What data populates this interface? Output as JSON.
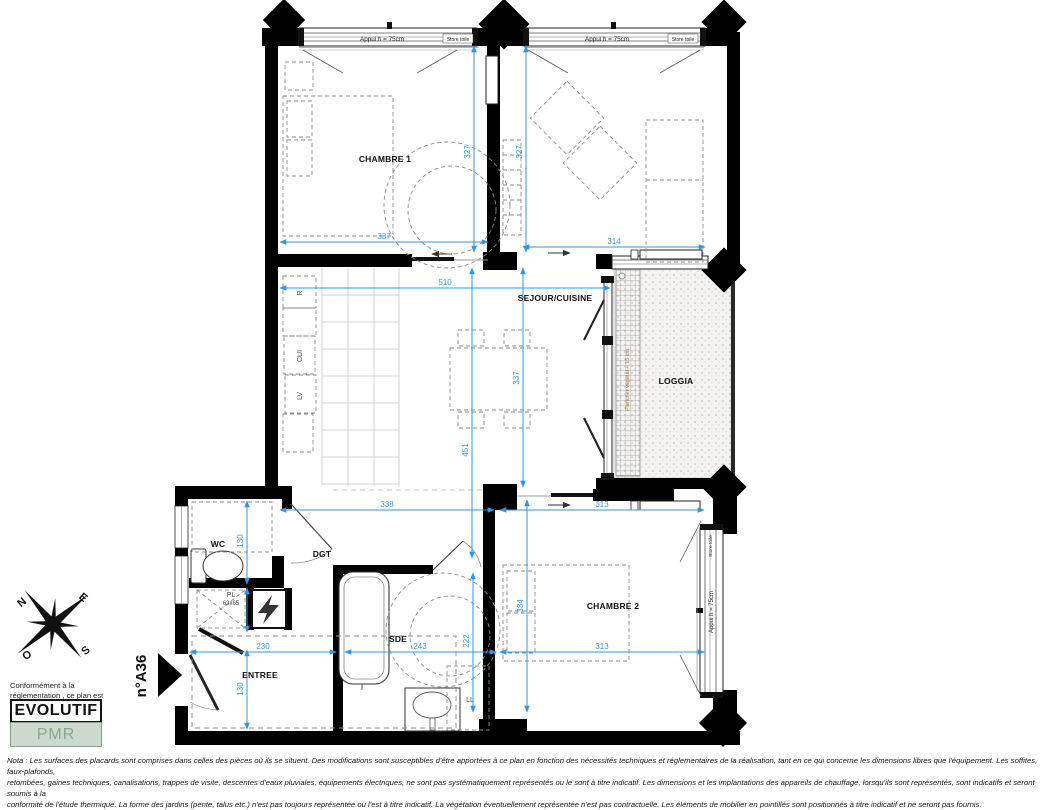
{
  "sheet": {
    "unit_number": "n°A36"
  },
  "rooms": {
    "chambre1": "CHAMBRE 1",
    "sejour": "SEJOUR/CUISINE",
    "loggia": "LOGGIA",
    "chambre2": "CHAMBRE 2",
    "wc": "WC",
    "dgt": "DGT",
    "sde": "SDE",
    "entree": "ENTREE",
    "pl": "PL"
  },
  "kitchen": {
    "r": "R",
    "cui": "CUI",
    "lv": "LV"
  },
  "dims": {
    "chambre1_w": "337",
    "sejour_right_w": "314",
    "chambre1_h": "327",
    "sejour_right_h": "327",
    "sejour_w": "510",
    "sejour_h": "337",
    "sejour_total_h": "451",
    "hall_w": "338",
    "chambre2_w_top": "313",
    "chambre2_w": "313",
    "chambre2_h": "334",
    "wc_h": "130",
    "entree_w": "230",
    "entree_h": "130",
    "sde_w": "243",
    "sde_h": "222"
  },
  "annotations": {
    "appui": "Appui h = 75cm",
    "store": "Store toile",
    "loggia_note": "Plancher végétal + 15 cm",
    "pl_size": "63x65",
    "ll": "LL"
  },
  "compass": {
    "n": "N",
    "e": "E",
    "s": "S",
    "o": "O"
  },
  "legend": {
    "conformity_line1": "Conformément à la",
    "conformity_line2": "réglementation , ce plan est",
    "evolutif": "EVOLUTIF",
    "pmr": "PMR"
  },
  "footer": {
    "line1": "Nota : Les surfaces des placards sont comprises dans celles des pièces où ils se situent. Des modifications sont susceptibles d'être apportées à ce plan en fonction des nécessités techniques et réglementaires de la réalisation, tant en ce qui concerne les dimensions libres que l'équipement. Les soffites, faux-plafonds,",
    "line2": "retombées, gaines techniques, canalisations, trappes de visite, descentes d'eaux pluviales, équipements électriques, ne sont pas systématiquement représentés ou le sont à titre indicatif. Les dimensions et les implantations des appareils de chauffage, lorsqu'ils sont représentés, sont indicatifs et seront soumis à la",
    "line3": "conformité de l'étude thermique. La forme des jardins (pente, talus etc.) n'est pas toujours représentée ou l'est à titre indicatif. La végétation éventuellement représentée n'est pas contractuelle. Les éléments de mobilier en pointillés sont positionnés à titre indicatif et ne seront pas fournis."
  },
  "colors": {
    "dimension": "#2f95ea",
    "wall": "#000000",
    "pmr_bg": "#cbdacc",
    "pmr_text": "#8ba793",
    "loggia_note_text": "#b06f38"
  }
}
